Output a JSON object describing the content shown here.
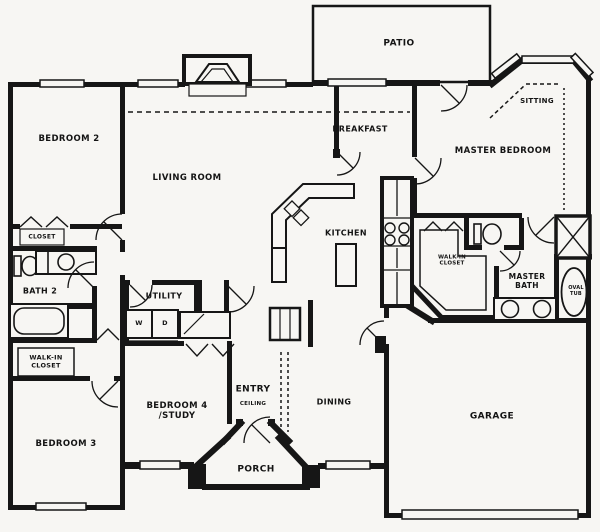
{
  "title": "House floor plan",
  "colors": {
    "background": "#f7f6f3",
    "line": "#161616",
    "paper": "#f7f6f3"
  },
  "rooms": [
    {
      "id": "patio",
      "label": "PATIO",
      "x": 399,
      "y": 44,
      "size": 9
    },
    {
      "id": "sitting",
      "label": "SITTING",
      "x": 537,
      "y": 101,
      "size": 7
    },
    {
      "id": "breakfast",
      "label": "BREAKFAST",
      "x": 360,
      "y": 129,
      "size": 8
    },
    {
      "id": "master-bedroom",
      "label": "MASTER BEDROOM",
      "x": 503,
      "y": 151,
      "size": 8.5
    },
    {
      "id": "bedroom-2",
      "label": "BEDROOM 2",
      "x": 69,
      "y": 139,
      "size": 8.5
    },
    {
      "id": "living-room",
      "label": "LIVING ROOM",
      "x": 187,
      "y": 178,
      "size": 8.5
    },
    {
      "id": "kitchen",
      "label": "KITCHEN",
      "x": 346,
      "y": 233,
      "size": 8
    },
    {
      "id": "closet-bedroom2",
      "label": "CLOSET",
      "x": 42,
      "y": 237,
      "size": 6
    },
    {
      "id": "bath-2",
      "label": "BATH 2",
      "x": 40,
      "y": 291,
      "size": 8
    },
    {
      "id": "walk-in-closet-left",
      "label": "WALK-IN\nCLOSET",
      "x": 46,
      "y": 362,
      "size": 6.5
    },
    {
      "id": "utility",
      "label": "UTILITY",
      "x": 164,
      "y": 296,
      "size": 8
    },
    {
      "id": "washer",
      "label": "W",
      "x": 139,
      "y": 324,
      "size": 6.5
    },
    {
      "id": "dryer",
      "label": "D",
      "x": 165,
      "y": 324,
      "size": 6.5
    },
    {
      "id": "bedroom-3",
      "label": "BEDROOM 3",
      "x": 66,
      "y": 444,
      "size": 8.5
    },
    {
      "id": "bedroom-4-study",
      "label": "BEDROOM 4\n/STUDY",
      "x": 177,
      "y": 411,
      "size": 8.5
    },
    {
      "id": "entry",
      "label": "ENTRY",
      "x": 253,
      "y": 390,
      "size": 9
    },
    {
      "id": "entry-ceiling",
      "label": "CEILING",
      "x": 253,
      "y": 404,
      "size": 5.5
    },
    {
      "id": "dining",
      "label": "DINING",
      "x": 334,
      "y": 402,
      "size": 8
    },
    {
      "id": "porch",
      "label": "PORCH",
      "x": 256,
      "y": 470,
      "size": 9
    },
    {
      "id": "garage",
      "label": "GARAGE",
      "x": 492,
      "y": 417,
      "size": 9
    },
    {
      "id": "master-walk-in-closet",
      "label": "WALK-IN\nCLOSET",
      "x": 452,
      "y": 261,
      "size": 5.5
    },
    {
      "id": "master-bath",
      "label": "MASTER\nBATH",
      "x": 527,
      "y": 282,
      "size": 7.5
    },
    {
      "id": "oval-tub",
      "label": "OVAL\nTUB",
      "x": 576,
      "y": 292,
      "size": 5
    }
  ],
  "fixtures": [
    "fireplace-icon",
    "range-burners-icon",
    "refrigerator-icon",
    "pantry-icon",
    "kitchen-sink-icon",
    "kitchen-island",
    "washer-box",
    "dryer-box",
    "bathtub-icon",
    "oval-tub-icon",
    "toilet-icon",
    "sink-icon",
    "shower-icon",
    "garage-door",
    "window",
    "door-swing-arc",
    "bifold-door-mark"
  ]
}
